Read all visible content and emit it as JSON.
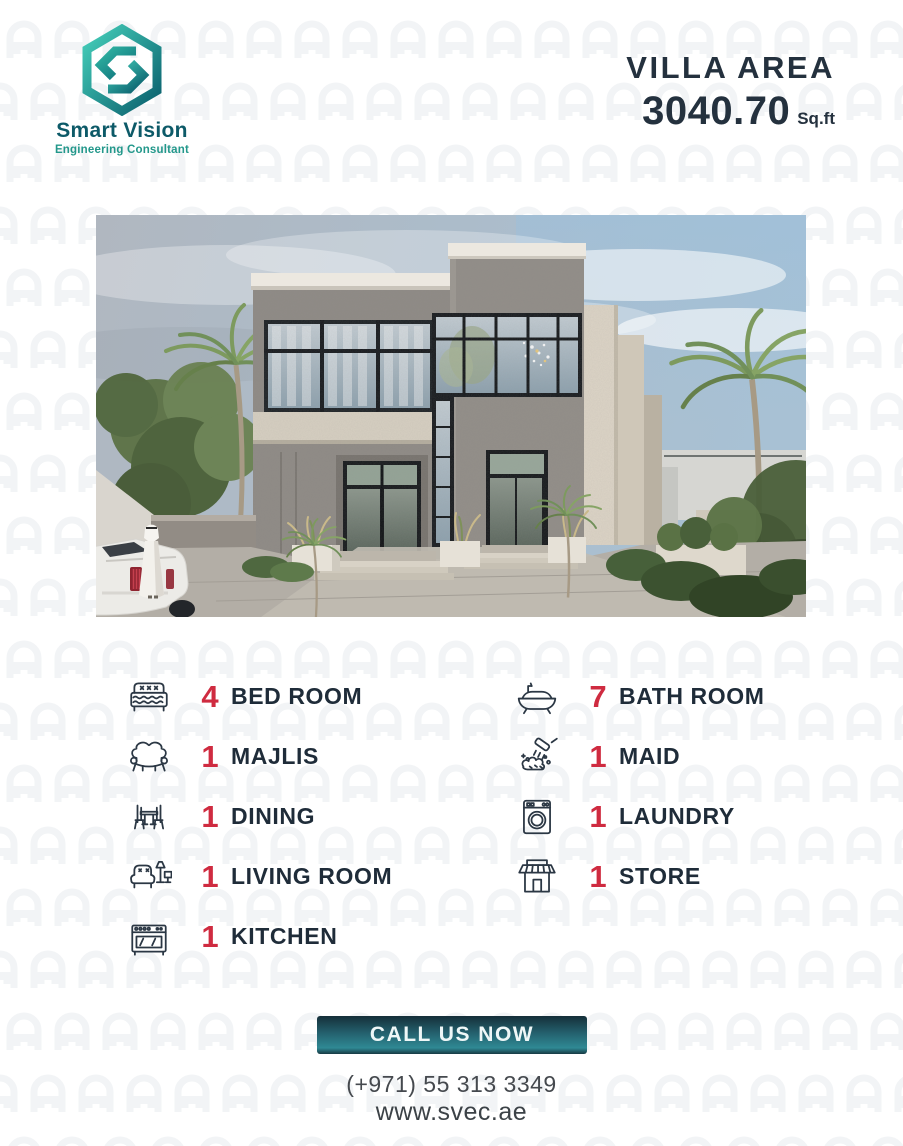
{
  "brand": {
    "name": "Smart Vision",
    "tagline": "Engineering Consultant",
    "logo_icon": "hexagon-s-logo"
  },
  "header": {
    "title": "VILLA AREA",
    "area_value": "3040.70",
    "area_unit": "Sq.ft"
  },
  "villa_image": {
    "description": "3D render of a modern grey two-storey villa with black-framed glass windows, palm trees, boundary wall, entrance steps, white car and a man in white kandura"
  },
  "features": {
    "left": [
      {
        "icon": "bed-icon",
        "count": "4",
        "label": "BED ROOM"
      },
      {
        "icon": "sofa-icon",
        "count": "1",
        "label": "MAJLIS"
      },
      {
        "icon": "dining-table-icon",
        "count": "1",
        "label": "DINING"
      },
      {
        "icon": "armchair-lamp-icon",
        "count": "1",
        "label": "LIVING ROOM"
      },
      {
        "icon": "stove-icon",
        "count": "1",
        "label": "KITCHEN"
      }
    ],
    "right": [
      {
        "icon": "bathtub-icon",
        "count": "7",
        "label": "BATH ROOM"
      },
      {
        "icon": "cleaning-brush-icon",
        "count": "1",
        "label": "MAID"
      },
      {
        "icon": "washing-machine-icon",
        "count": "1",
        "label": "LAUNDRY"
      },
      {
        "icon": "storefront-icon",
        "count": "1",
        "label": "STORE"
      }
    ]
  },
  "footer": {
    "cta_label": "CALL US NOW",
    "phone": "(+971) 55 313 3349",
    "website": "www.svec.ae"
  },
  "colors": {
    "navy": "#22303d",
    "red": "#cf2b40",
    "teal": "#23988b",
    "teal_dark": "#0d5a68",
    "button_teal": "#2d808c",
    "pattern_grey": "#f3f5f7"
  }
}
